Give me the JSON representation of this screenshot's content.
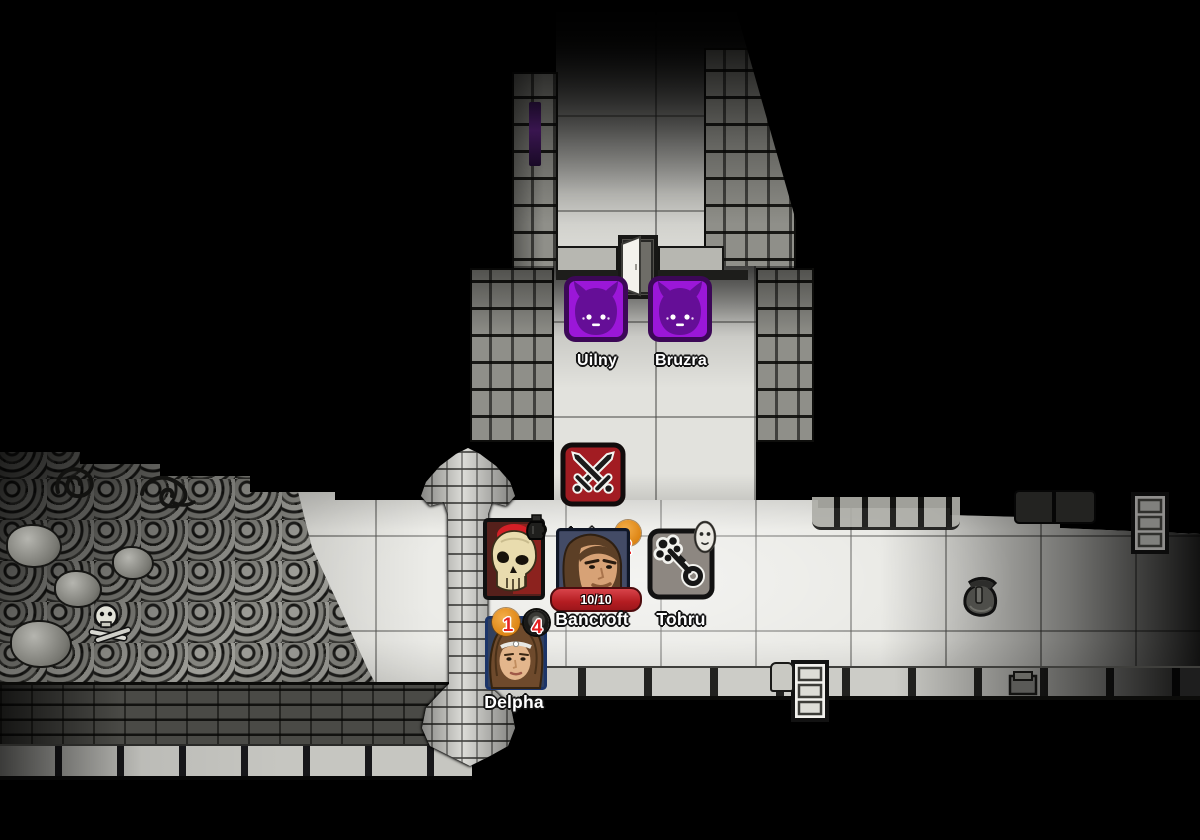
{
  "creatures": [
    {
      "label": "Uilny",
      "kind": "purple-demon"
    },
    {
      "label": "Bruzra",
      "kind": "purple-demon"
    },
    {
      "label": "Irulan",
      "kind": "fighting",
      "icon": "crossed-swords-icon"
    },
    {
      "label": "Bancroft",
      "kind": "human-portrait",
      "hp": "10/10",
      "badge": "2"
    },
    {
      "label": "Tohru",
      "kind": "key-creature",
      "icon": "bone-key-icon",
      "secondary_icon": "white-mask-icon"
    },
    {
      "label": "Delpha",
      "kind": "human-portrait",
      "badges": [
        "1",
        "4"
      ]
    },
    {
      "label": "",
      "kind": "skull-portrait",
      "icon": "skull-icon"
    }
  ],
  "items": [
    {
      "name": "satchel"
    },
    {
      "name": "shelf-dim"
    },
    {
      "name": "shelf"
    },
    {
      "name": "crate"
    },
    {
      "name": "open-door"
    }
  ],
  "decor": [
    "iron-coil",
    "iron-coil",
    "iron-coil",
    "skull-and-bones"
  ],
  "colors": {
    "background": "#000000",
    "floor_light": "#e6e6e1",
    "demon_purple": "#9b17d8",
    "demon_border": "#3c0857",
    "demon_face": "#650e97",
    "fight_tile_red": "#a21c22",
    "hp_bar_red": "#b51d22",
    "badge_orange": "#dd8514",
    "badge_number_red": "#e62222",
    "portrait_border_blue": "#24407c",
    "label_white": "#ffffff"
  }
}
